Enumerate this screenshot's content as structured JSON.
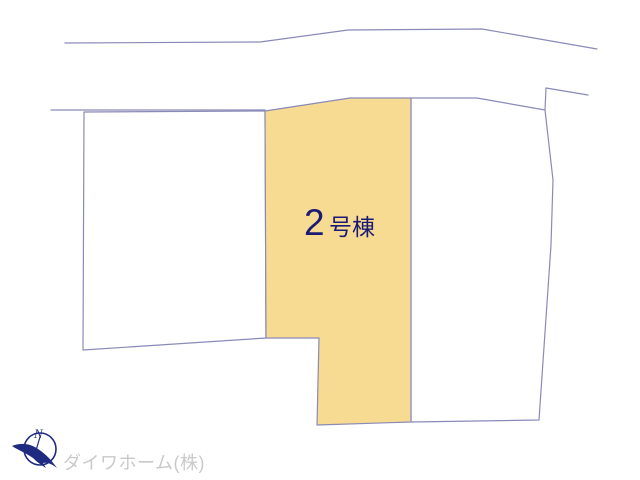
{
  "canvas": {
    "width": 640,
    "height": 480
  },
  "colors": {
    "line-color": "#8a8ab8",
    "highlight-fill": "#f8db92",
    "label-color": "#1b1b74",
    "compass-color": "#1e2b80",
    "watermark-color": "#c9c9c9"
  },
  "plan": {
    "roads": {
      "upper_edge": "65,43 260,42 348,30 482,29 597,49",
      "lower_edge_left": "51,110 265,110",
      "flag_line": "588,95 546,88 545,110"
    },
    "parcels": {
      "left": {
        "points": "84,112 265,111 266,338 83,350"
      },
      "right": {
        "points": "411,98 477,98 545,110 553,180 551,245 539,420 411,422"
      },
      "center": {
        "points": "265,111 350,98 411,98 411,422 317,425 319,338 266,338"
      }
    }
  },
  "lot": {
    "number": "2",
    "suffix": "号棟"
  },
  "compass": {
    "north_label": "N"
  },
  "watermark": {
    "text": "ダイワホーム(株)"
  }
}
